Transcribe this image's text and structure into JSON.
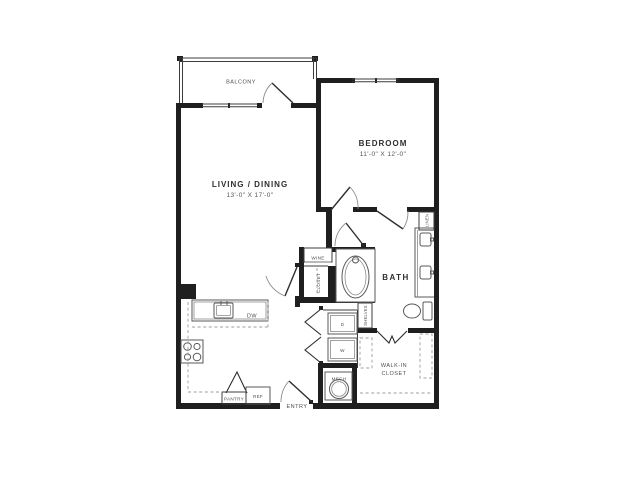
{
  "plan_title": "One-bedroom apartment floor plan",
  "rooms": {
    "balcony": {
      "label": "BALCONY"
    },
    "living_dining": {
      "label": "LIVING / DINING",
      "dimensions": "13'-0\" X 17'-0\""
    },
    "bedroom": {
      "label": "BEDROOM",
      "dimensions": "11'-0\" X 12'-0\""
    },
    "bath": {
      "label": "BATH"
    },
    "walk_in_closet": {
      "label_line1": "WALK-IN",
      "label_line2": "CLOSET"
    },
    "wine_closet": {
      "label": "WINE"
    },
    "hall_closet": {
      "label": "CLOSET"
    },
    "linen_closet": {
      "label": "LINEN"
    },
    "shelves": {
      "label": "SHELVES"
    },
    "mech_room": {
      "label": "MECH"
    },
    "pantry": {
      "label": "PANTRY"
    },
    "entry": {
      "label": "ENTRY"
    }
  },
  "appliances": {
    "dishwasher": {
      "label": "DW"
    },
    "refrigerator": {
      "label": "REF"
    },
    "dryer": {
      "label": "D"
    },
    "washer": {
      "label": "W"
    }
  },
  "colors": {
    "wall": "#1f1f1f",
    "fixture_line": "#5a5a5a",
    "text": "#3f3f3f",
    "dash": "#9d9d9d",
    "background": "#ffffff"
  }
}
